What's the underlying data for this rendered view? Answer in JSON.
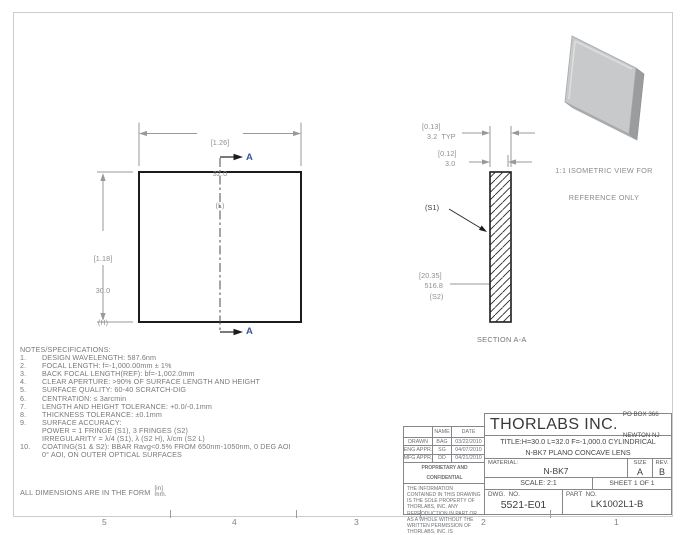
{
  "palette": {
    "drawing_line": "#1c1c1e",
    "dimension_gray": "#97999b",
    "text_gray": "#77797c",
    "cut_label_blue": "#3a55a0",
    "plate_gray": "#c7c9cb",
    "border_gray": "#caccce"
  },
  "front_view": {
    "length_dim": {
      "inch": "[1.26]",
      "mm": "32.0",
      "axis": "(L)"
    },
    "height_dim": {
      "inch": "[1.18]",
      "mm": "30.0",
      "axis": "(H)"
    },
    "cut_label_top": "A",
    "cut_label_bottom": "A"
  },
  "section_view": {
    "caption": "SECTION A-A",
    "edge_thickness": {
      "inch": "[0.13]",
      "mm_typ": "3.2  TYP"
    },
    "center_thickness": {
      "inch": "[0.12]",
      "mm": "3.0"
    },
    "surface1_label": "(S1)",
    "radius_dim": {
      "inch": "[20.35]",
      "mm": "516.8",
      "surface": "(S2)"
    }
  },
  "isometric": {
    "caption_line1": "1:1 ISOMETRIC VIEW FOR",
    "caption_line2": "REFERENCE ONLY"
  },
  "notes": {
    "heading": "NOTES/SPECIFICATIONS:",
    "rows": [
      {
        "num": "1.",
        "text": "DESIGN WAVELENGTH: 587.6nm"
      },
      {
        "num": "2.",
        "text": "FOCAL LENGTH: f=-1,000.00mm ± 1%"
      },
      {
        "num": "3.",
        "text": "BACK FOCAL LENGTH(REF): bf=-1,002.0mm"
      },
      {
        "num": "4.",
        "text": "CLEAR APERTURE: >90% OF SURFACE LENGTH AND HEIGHT"
      },
      {
        "num": "5.",
        "text": "SURFACE QUALITY: 60-40 SCRATCH-DIG"
      },
      {
        "num": "6.",
        "text": "CENTRATION: ≤ 3arcmin"
      },
      {
        "num": "7.",
        "text": "LENGTH AND HEIGHT TOLERANCE: +0.0/-0.1mm"
      },
      {
        "num": "8.",
        "text": "THICKNESS TOLERANCE: ±0.1mm"
      },
      {
        "num": "9.",
        "text": "SURFACE ACCURACY:"
      },
      {
        "num": "",
        "text": "POWER = 1 FRINGE (S1), 3 FRINGES (S2)"
      },
      {
        "num": "",
        "text": "IRREGULARITY = λ/4 (S1), λ (S2 H), λ/cm (S2 L)"
      },
      {
        "num": "10.",
        "text": "COATING(S1 & S2): BBAR Ravg<0.5% FROM 650nm-1050nm, 0 DEG AOI"
      },
      {
        "num": "",
        "text": "0° AOI, ON OUTER OPTICAL SURFACES"
      }
    ]
  },
  "units_note": {
    "prefix": "ALL DIMENSIONS ARE IN THE FORM",
    "numerator": "[in]",
    "denominator": "mm."
  },
  "title_block": {
    "company": "THORLABS INC.",
    "address_line1": "PO BOX 366",
    "address_line2": "NEWTON NJ",
    "title_line1": "TITLE:H=30.0 L=32.0 F=-1,000.0 CYLINDRICAL",
    "title_line2": "N-BK7 PLANO CONCAVE LENS",
    "material_label": "MATERIAL:",
    "material": "N-BK7",
    "size_label": "SIZE",
    "size": "A",
    "rev_label": "REV.",
    "rev": "B",
    "scale": "SCALE: 2:1",
    "sheet": "SHEET 1 OF 1",
    "dwg_label": "DWG.  NO.",
    "dwg_no": "5521-E01",
    "part_label": "PART  NO.",
    "part_no": "LK1002L1-B",
    "approvals": {
      "name_header": "NAME",
      "date_header": "DATE",
      "rows": [
        {
          "role": "DRAWN",
          "name": "BAG",
          "date": "03/22/2010"
        },
        {
          "role": "ENG APPR.",
          "name": "SG",
          "date": "04/07/2010"
        },
        {
          "role": "MFG APPR.",
          "name": "DD",
          "date": "04/21/2010"
        }
      ]
    },
    "proprietary_heading": "PROPRIETARY AND CONFIDENTIAL",
    "proprietary_text": "THE INFORMATION CONTAINED IN THIS DRAWING IS THE SOLE PROPERTY OF THORLABS, INC.  ANY REPRODUCTION IN PART OR AS A WHOLE WITHOUT THE WRITTEN PERMISSION OF THORLABS, INC. IS PROHIBITED."
  },
  "zones": [
    "5",
    "4",
    "3",
    "2",
    "1"
  ]
}
